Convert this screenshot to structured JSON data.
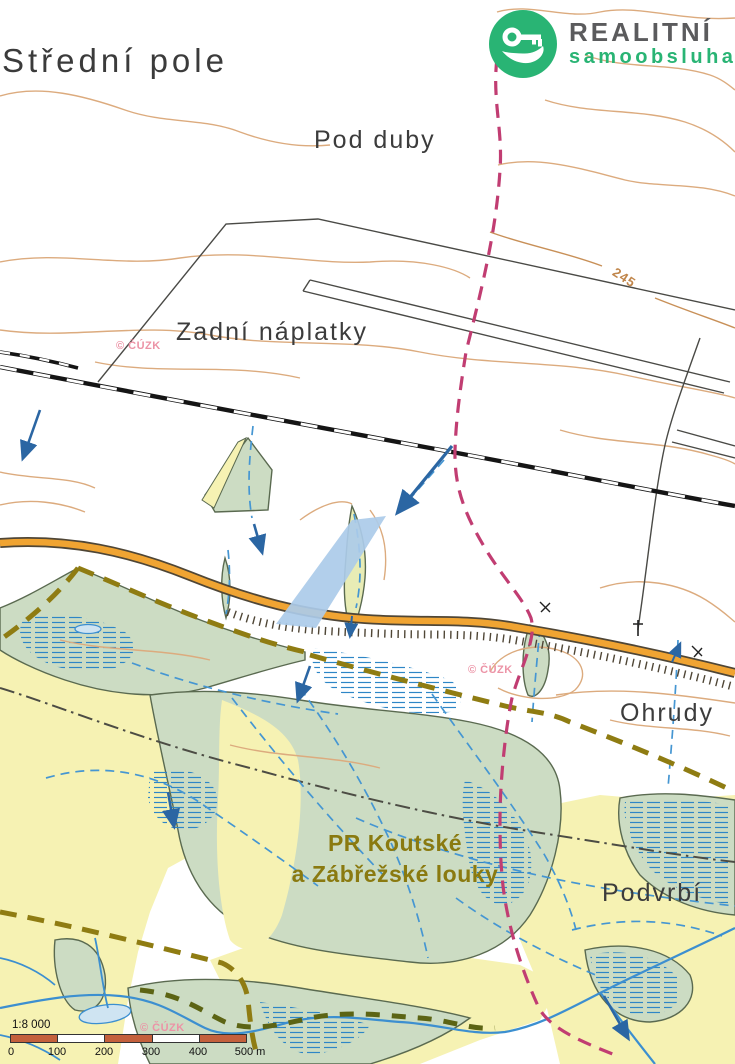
{
  "brand": {
    "name": "REALITNÍ",
    "subtitle": "samoobsluha",
    "logo_icon": "key-in-hand",
    "colors": {
      "green": "#29b474",
      "gray": "#5b5b5d"
    }
  },
  "map_labels": {
    "stredni_pole": "Střední pole",
    "pod_duby": "Pod duby",
    "zadni_naplatky": "Zadní náplatky",
    "ohrudy": "Ohrudy",
    "podvrbi": "Podvrbí"
  },
  "reserve_label": {
    "line1": "PR Koutské",
    "line2": "a Zábřežské louky"
  },
  "contour_label": "245",
  "watermark": "© ČÚZK",
  "scale": {
    "ratio": "1:8 000",
    "ticks": [
      "0",
      "100",
      "200",
      "300",
      "400",
      "500 m"
    ]
  },
  "colors": {
    "meadow_green": "#ccdcc3",
    "field_yellow": "#f6f2b3",
    "marsh_hatch_blue": "#2e86c6",
    "ditch_blue": "#4596d2",
    "arrow_blue": "#2b66a3",
    "water_blue": "#3c8fd0",
    "pond_fill": "#cfe4f2",
    "parcel_highlight": "#abcbe9",
    "road_orange": "#f0a432",
    "road_casing": "#4f4636",
    "railway_black": "#151515",
    "contour_tan": "#dcab7e",
    "cadastre_magenta": "#c13d72",
    "reserve_olive": "#8f7c12",
    "municipal_gray": "#4c4c44",
    "bank_olive": "#5c6414",
    "scalebar_red": "#c4603c"
  }
}
